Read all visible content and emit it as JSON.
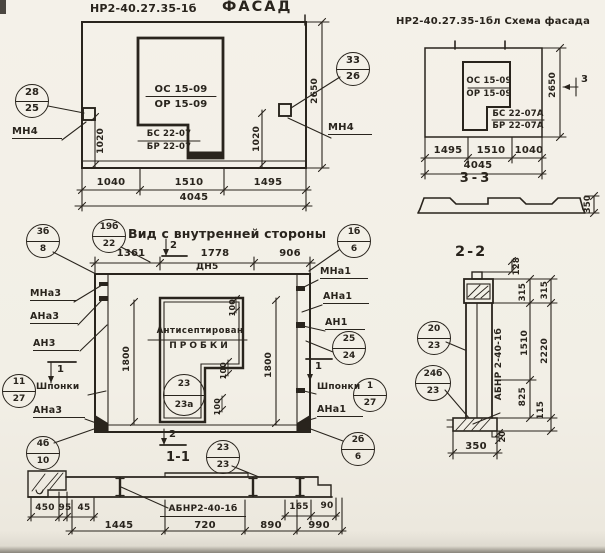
{
  "colors": {
    "paper": "#f2efe6",
    "ink": "#29241d"
  },
  "facade": {
    "code": "НР2-40.27.35-1б",
    "title": "Фасад",
    "win_top1": "ОС 15-09",
    "win_top2": "ОР 15-09",
    "win_bot1": "БС 22-07",
    "win_bot2": "БР 22-07",
    "callout_left": {
      "top": "28",
      "bot": "25"
    },
    "callout_right": {
      "top": "33",
      "bot": "26"
    },
    "anchor_left": "МН4",
    "anchor_right": "МН4",
    "dim_v_left": "1020",
    "dim_v_right": "1020",
    "dim_height": "2650",
    "dims_bottom": [
      "1040",
      "1510",
      "1495"
    ],
    "dim_total": "4045"
  },
  "scheme": {
    "code": "НР2-40.27.35-1бл",
    "title": "Схема фасада",
    "win_top1": "ОС 15-09",
    "win_top2": "ОР 15-09",
    "win_bot1": "БС 22-07А",
    "win_bot2": "БР 22-07А",
    "dim_height": "2650",
    "marker": "3",
    "dims_bottom": [
      "1495",
      "1510",
      "1040"
    ],
    "dim_total": "4045"
  },
  "section33": {
    "title": "3-3",
    "dim_thickness": "350"
  },
  "inner": {
    "title": "Вид с внутренней стороны",
    "note_top": "ДН5",
    "note1": "Антисептирован",
    "note2": "пробки",
    "markers": {
      "top": "2",
      "bottom": "2",
      "left": "1",
      "right": "1"
    },
    "dims_top": [
      "1361",
      "1778",
      "906"
    ],
    "dim_v_left": "1800",
    "dim_v_right": "1800",
    "plug_dims": [
      "100",
      "100",
      "100"
    ],
    "labels_left": [
      "МНа3",
      "АНа3",
      "АН3",
      "Шпонки",
      "АНа3"
    ],
    "labels_right": [
      "МНа1",
      "АНа1",
      "АН1",
      "Шпонки",
      "АНа1"
    ],
    "callouts": {
      "c38": {
        "top": "3б",
        "bot": "8"
      },
      "c19": {
        "top": "19б",
        "bot": "22"
      },
      "c16": {
        "top": "1б",
        "bot": "6"
      },
      "c2524": {
        "top": "25",
        "bot": "24"
      },
      "c1127": {
        "top": "11",
        "bot": "27"
      },
      "c127": {
        "top": "1",
        "bot": "27"
      },
      "c2323a": {
        "top": "23",
        "bot": "23а"
      },
      "c4610": {
        "top": "4б",
        "bot": "10"
      },
      "c266": {
        "top": "2б",
        "bot": "6"
      },
      "c2323": {
        "top": "23",
        "bot": "23"
      }
    },
    "title_section11": "1-1"
  },
  "section11": {
    "label": "АБНР2-40-1б",
    "dims_small": [
      "450",
      "95",
      "45"
    ],
    "dims_right": [
      "165",
      "90"
    ],
    "dims_bottom": [
      "1445",
      "720",
      "890",
      "990"
    ]
  },
  "section22": {
    "title": "2-2",
    "label": "АБНР 2-40-1б",
    "callout_top": {
      "top": "20",
      "bot": "23"
    },
    "callout_bot": {
      "top": "24б",
      "bot": "23"
    },
    "dim_128": "128",
    "dims_inner": [
      "315",
      "1510",
      "825"
    ],
    "dims_outer": [
      "315",
      "2220",
      "115"
    ],
    "dim_20": "20",
    "dim_350": "350"
  }
}
